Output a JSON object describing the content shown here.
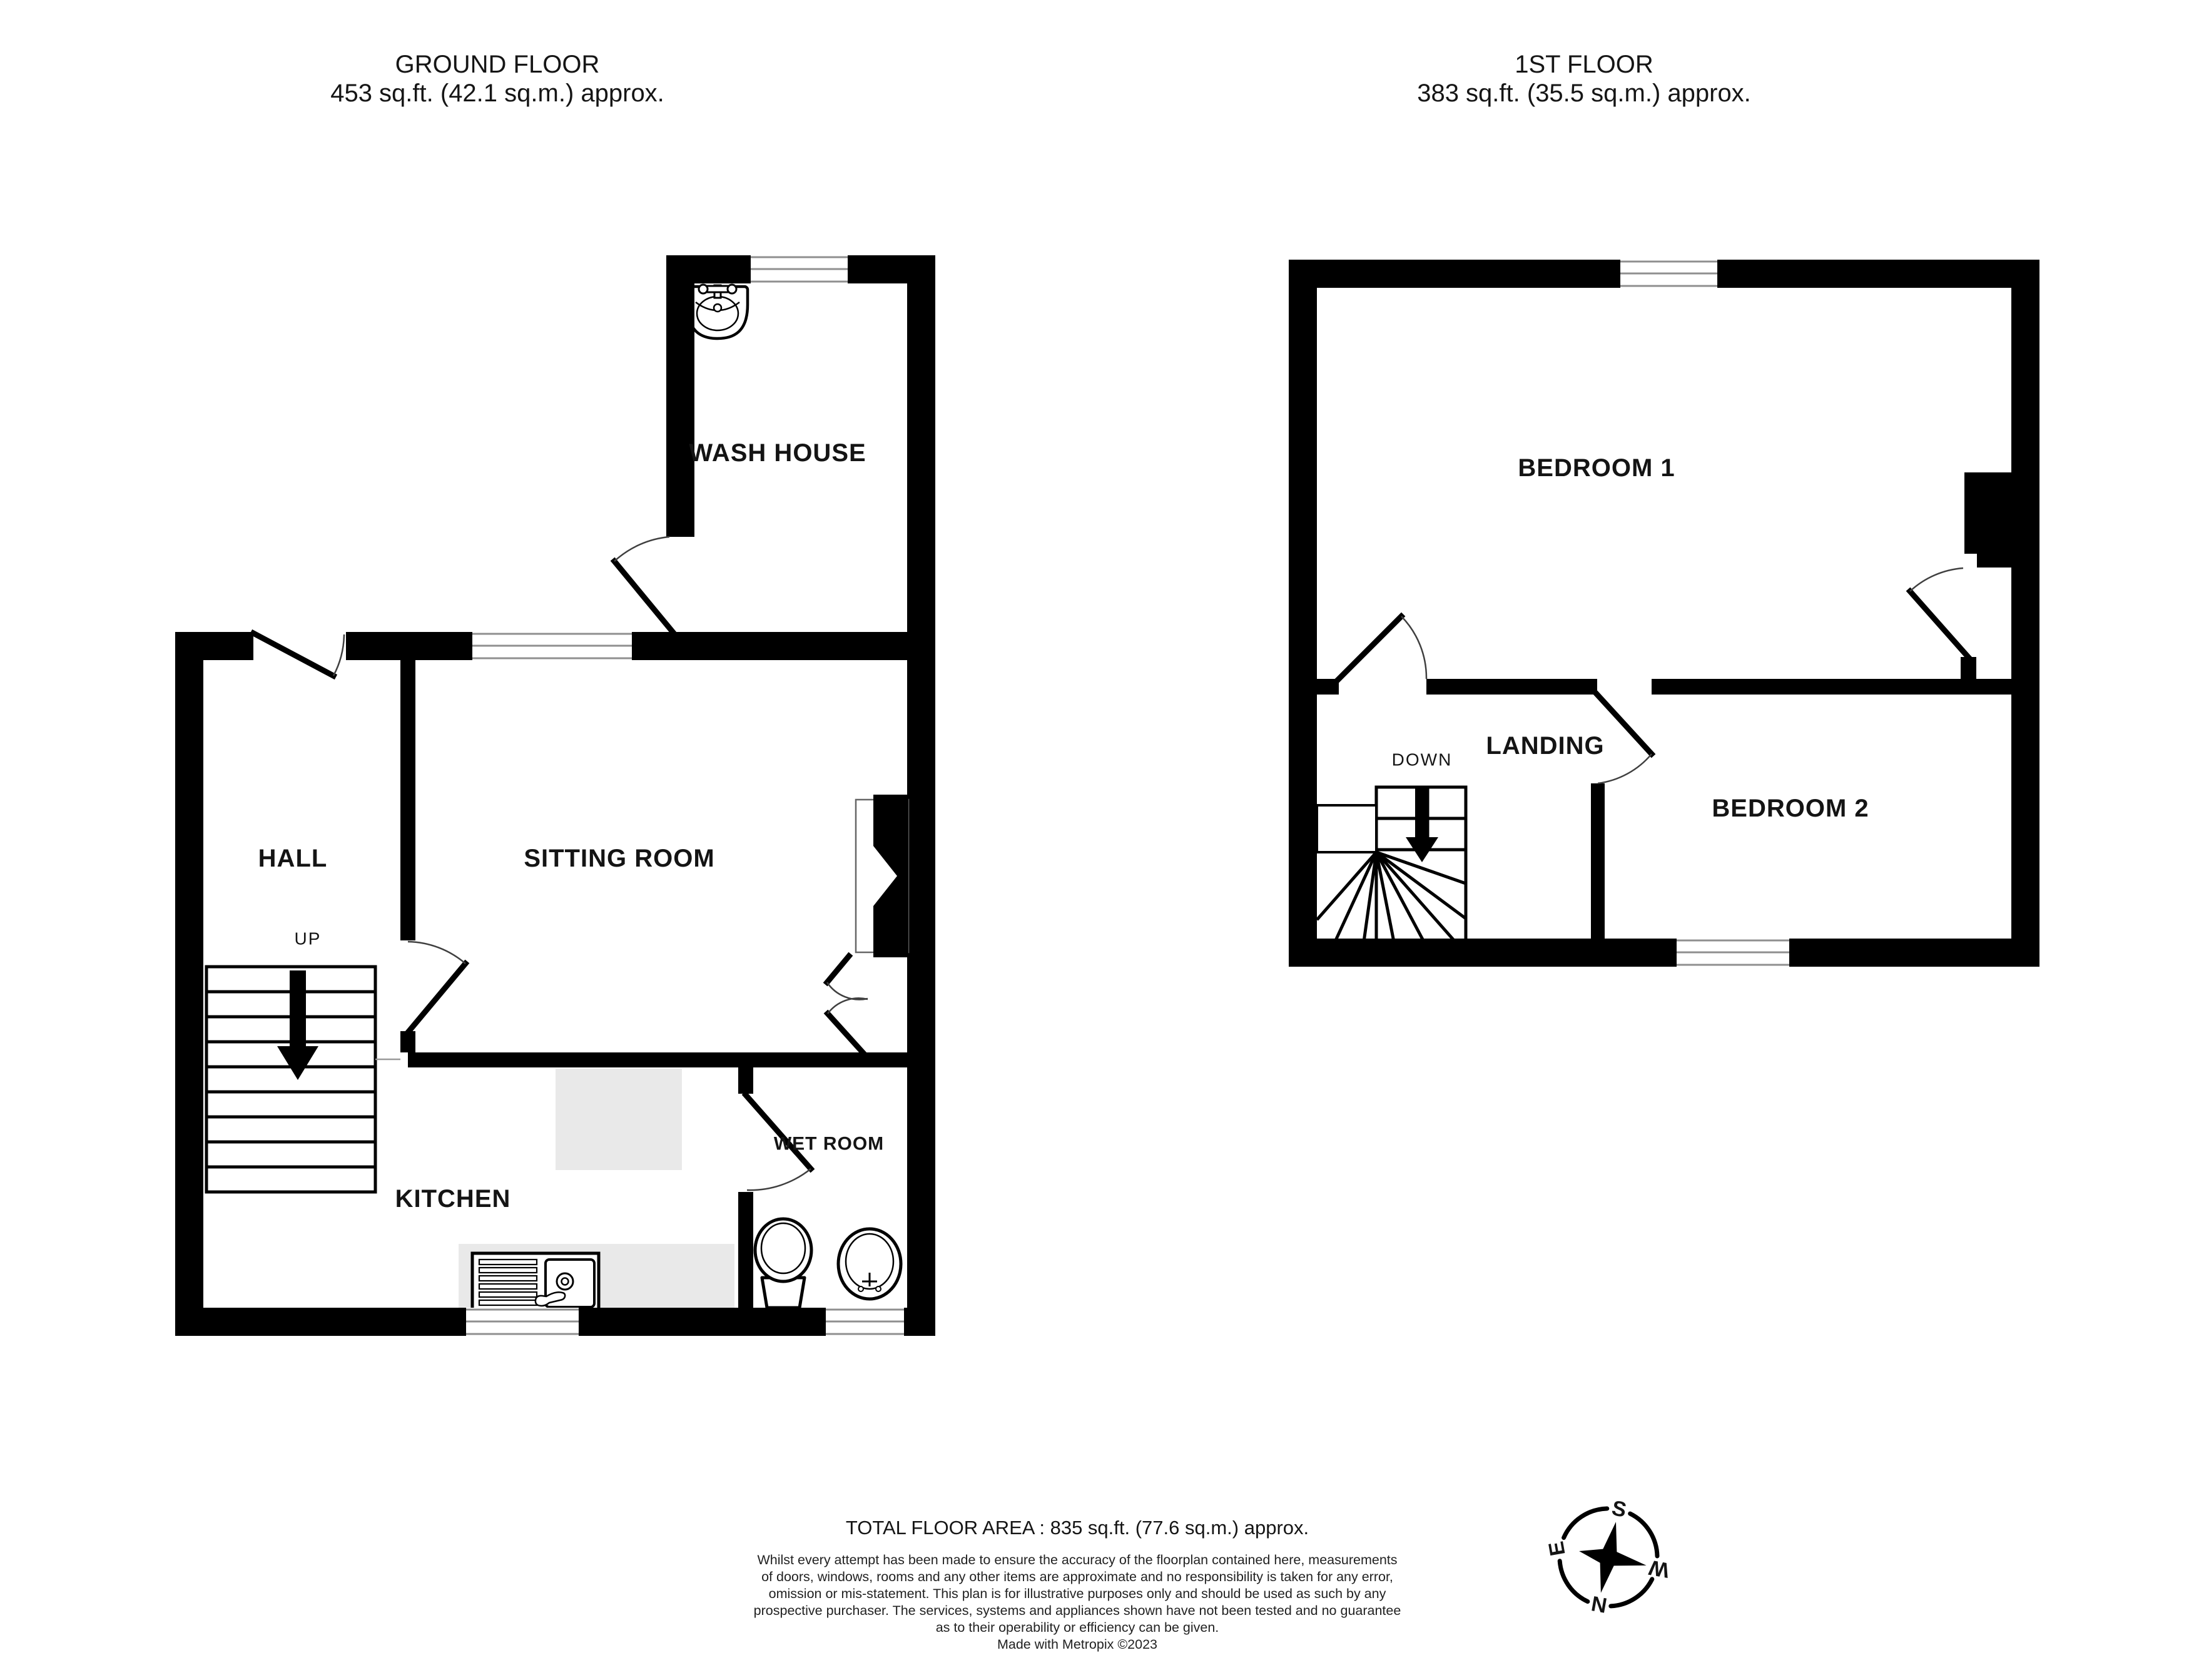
{
  "ground_floor": {
    "title": "GROUND FLOOR",
    "area": "453 sq.ft. (42.1 sq.m.) approx.",
    "rooms": {
      "wash_house": "WASH HOUSE",
      "hall": "HALL",
      "sitting_room": "SITTING ROOM",
      "kitchen": "KITCHEN",
      "wet_room": "WET ROOM"
    },
    "stairs_label": "UP"
  },
  "first_floor": {
    "title": "1ST FLOOR",
    "area": "383 sq.ft. (35.5 sq.m.) approx.",
    "rooms": {
      "bedroom1": "BEDROOM 1",
      "landing": "LANDING",
      "bedroom2": "BEDROOM 2"
    },
    "stairs_label": "DOWN"
  },
  "footer": {
    "total_area": "TOTAL FLOOR AREA : 835 sq.ft. (77.6 sq.m.) approx.",
    "disclaimer_lines": [
      "Whilst every attempt has been made to ensure the accuracy of the floorplan contained here, measurements",
      "of doors, windows, rooms and any other items are approximate and no responsibility is taken for any error,",
      "omission or mis-statement. This plan is for illustrative purposes only and should be used as such by any",
      "prospective purchaser. The services, systems and appliances shown have not been tested and no guarantee",
      "as to their operability or efficiency can be given."
    ],
    "credit": "Made with Metropix ©2023"
  },
  "compass": {
    "north": "N",
    "south": "S",
    "east": "E",
    "west": "W"
  },
  "colors": {
    "wall": "#000000",
    "floor": "#ffffff",
    "worktop": "#e9e9e9",
    "window_line": "#8f8f8f",
    "door_arc": "#3f3f3f"
  }
}
